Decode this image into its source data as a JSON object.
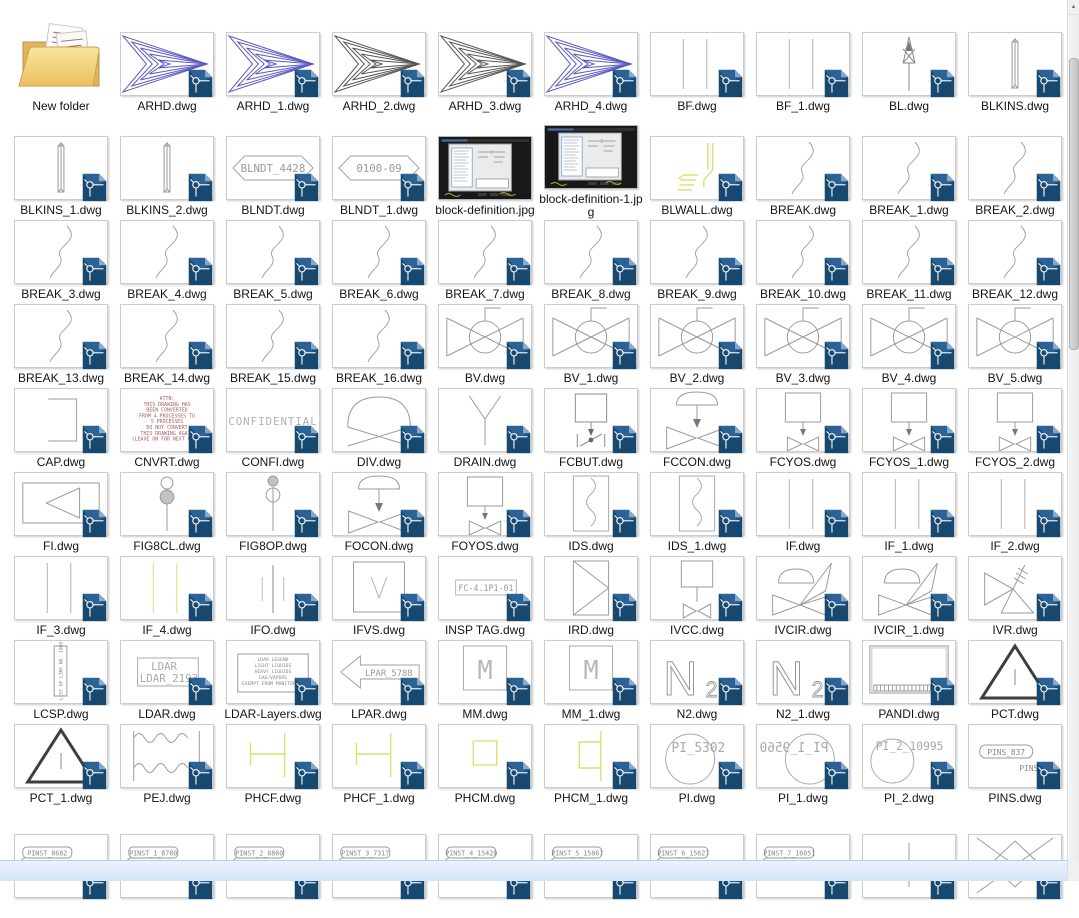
{
  "colors": {
    "dwg_badge_blue": "#17486f",
    "cad_line_gray": "#9a9a9a",
    "cad_blue": "#5b5bc0",
    "cad_dark": "#4f4f4f",
    "cad_yellow": "#dede6e",
    "cad_red": "#a75f5f",
    "folder_yellow": "#f0d47e",
    "scroll_strip_blue": "#d9e9f9"
  },
  "files": [
    {
      "label": "New folder",
      "kind": "folder"
    },
    {
      "label": "ARHD.dwg",
      "kind": "dwg",
      "glyph": "arrow",
      "variant": "blue"
    },
    {
      "label": "ARHD_1.dwg",
      "kind": "dwg",
      "glyph": "arrow",
      "variant": "blue"
    },
    {
      "label": "ARHD_2.dwg",
      "kind": "dwg",
      "glyph": "arrow",
      "variant": "dark"
    },
    {
      "label": "ARHD_3.dwg",
      "kind": "dwg",
      "glyph": "arrow",
      "variant": "dark"
    },
    {
      "label": "ARHD_4.dwg",
      "kind": "dwg",
      "glyph": "arrow",
      "variant": "blue"
    },
    {
      "label": "BF.dwg",
      "kind": "dwg",
      "glyph": "vlines2",
      "variant": "gray"
    },
    {
      "label": "BF_1.dwg",
      "kind": "dwg",
      "glyph": "vlines2",
      "variant": "gray"
    },
    {
      "label": "BL.dwg",
      "kind": "dwg",
      "glyph": "antenna"
    },
    {
      "label": "BLKINS.dwg",
      "kind": "dwg",
      "glyph": "bar3d"
    },
    {
      "label": "BLKINS_1.dwg",
      "kind": "dwg",
      "glyph": "bar3d"
    },
    {
      "label": "BLKINS_2.dwg",
      "kind": "dwg",
      "glyph": "bar3d"
    },
    {
      "label": "BLNDT.dwg",
      "kind": "dwg",
      "glyph": "hextag",
      "texts": [
        "BLNDT_4428"
      ]
    },
    {
      "label": "BLNDT_1.dwg",
      "kind": "dwg",
      "glyph": "hextag",
      "texts": [
        "0100-09"
      ]
    },
    {
      "label": "block-definition.jpg",
      "kind": "jpg",
      "variant": "1"
    },
    {
      "label": "block-definition-1.jpg",
      "kind": "jpg",
      "variant": "2"
    },
    {
      "label": "BLWALL.dwg",
      "kind": "dwg",
      "glyph": "blwall"
    },
    {
      "label": "BREAK.dwg",
      "kind": "dwg",
      "glyph": "scurve"
    },
    {
      "label": "BREAK_1.dwg",
      "kind": "dwg",
      "glyph": "scurve"
    },
    {
      "label": "BREAK_2.dwg",
      "kind": "dwg",
      "glyph": "scurve"
    },
    {
      "label": "BREAK_3.dwg",
      "kind": "dwg",
      "glyph": "scurve"
    },
    {
      "label": "BREAK_4.dwg",
      "kind": "dwg",
      "glyph": "scurve"
    },
    {
      "label": "BREAK_5.dwg",
      "kind": "dwg",
      "glyph": "scurve"
    },
    {
      "label": "BREAK_6.dwg",
      "kind": "dwg",
      "glyph": "scurve"
    },
    {
      "label": "BREAK_7.dwg",
      "kind": "dwg",
      "glyph": "scurve"
    },
    {
      "label": "BREAK_8.dwg",
      "kind": "dwg",
      "glyph": "scurve"
    },
    {
      "label": "BREAK_9.dwg",
      "kind": "dwg",
      "glyph": "scurve"
    },
    {
      "label": "BREAK_10.dwg",
      "kind": "dwg",
      "glyph": "scurve"
    },
    {
      "label": "BREAK_11.dwg",
      "kind": "dwg",
      "glyph": "scurve"
    },
    {
      "label": "BREAK_12.dwg",
      "kind": "dwg",
      "glyph": "scurve"
    },
    {
      "label": "BREAK_13.dwg",
      "kind": "dwg",
      "glyph": "scurve"
    },
    {
      "label": "BREAK_14.dwg",
      "kind": "dwg",
      "glyph": "scurve"
    },
    {
      "label": "BREAK_15.dwg",
      "kind": "dwg",
      "glyph": "scurve"
    },
    {
      "label": "BREAK_16.dwg",
      "kind": "dwg",
      "glyph": "scurve"
    },
    {
      "label": "BV.dwg",
      "kind": "dwg",
      "glyph": "ballvalve"
    },
    {
      "label": "BV_1.dwg",
      "kind": "dwg",
      "glyph": "ballvalve"
    },
    {
      "label": "BV_2.dwg",
      "kind": "dwg",
      "glyph": "ballvalve"
    },
    {
      "label": "BV_3.dwg",
      "kind": "dwg",
      "glyph": "ballvalve"
    },
    {
      "label": "BV_4.dwg",
      "kind": "dwg",
      "glyph": "ballvalve"
    },
    {
      "label": "BV_5.dwg",
      "kind": "dwg",
      "glyph": "ballvalve"
    },
    {
      "label": "CAP.dwg",
      "kind": "dwg",
      "glyph": "cap"
    },
    {
      "label": "CNVRT.dwg",
      "kind": "dwg",
      "glyph": "redtext",
      "texts": [
        "ATTN:",
        "THIS DRAWING HAS",
        "BEEN CONVERTED",
        "FROM 4 PROCESSES TO",
        "5 PROCESSES",
        "DO NOT CONVERT",
        "THIS DRAWING AGAIN",
        "(LEAVE ON FOR NEXT USER)"
      ]
    },
    {
      "label": "CONFI.dwg",
      "kind": "dwg",
      "glyph": "confidential",
      "texts": [
        "CONFIDENTIAL"
      ]
    },
    {
      "label": "DIV.dwg",
      "kind": "dwg",
      "glyph": "domex"
    },
    {
      "label": "DRAIN.dwg",
      "kind": "dwg",
      "glyph": "drainY"
    },
    {
      "label": "FCBUT.dwg",
      "kind": "dwg",
      "glyph": "fcbut"
    },
    {
      "label": "FCCON.dwg",
      "kind": "dwg",
      "glyph": "fccon"
    },
    {
      "label": "FCYOS.dwg",
      "kind": "dwg",
      "glyph": "fcyos"
    },
    {
      "label": "FCYOS_1.dwg",
      "kind": "dwg",
      "glyph": "fcyos"
    },
    {
      "label": "FCYOS_2.dwg",
      "kind": "dwg",
      "glyph": "fcyos"
    },
    {
      "label": "FI.dwg",
      "kind": "dwg",
      "glyph": "fi"
    },
    {
      "label": "FIG8CL.dwg",
      "kind": "dwg",
      "glyph": "fig8",
      "variant": "cl"
    },
    {
      "label": "FIG8OP.dwg",
      "kind": "dwg",
      "glyph": "fig8",
      "variant": "op"
    },
    {
      "label": "FOCON.dwg",
      "kind": "dwg",
      "glyph": "fccon"
    },
    {
      "label": "FOYOS.dwg",
      "kind": "dwg",
      "glyph": "fcyos"
    },
    {
      "label": "IDS.dwg",
      "kind": "dwg",
      "glyph": "ids"
    },
    {
      "label": "IDS_1.dwg",
      "kind": "dwg",
      "glyph": "ids"
    },
    {
      "label": "IF.dwg",
      "kind": "dwg",
      "glyph": "vlines2",
      "variant": "gray"
    },
    {
      "label": "IF_1.dwg",
      "kind": "dwg",
      "glyph": "vlines2",
      "variant": "gray"
    },
    {
      "label": "IF_2.dwg",
      "kind": "dwg",
      "glyph": "vlines2",
      "variant": "gray"
    },
    {
      "label": "IF_3.dwg",
      "kind": "dwg",
      "glyph": "vlines2",
      "variant": "gray"
    },
    {
      "label": "IF_4.dwg",
      "kind": "dwg",
      "glyph": "vlines2",
      "variant": "yellow"
    },
    {
      "label": "IFO.dwg",
      "kind": "dwg",
      "glyph": "ifo"
    },
    {
      "label": "IFVS.dwg",
      "kind": "dwg",
      "glyph": "ifvs"
    },
    {
      "label": "INSP TAG.dwg",
      "kind": "dwg",
      "glyph": "insptag",
      "texts": [
        "FC-4.1P1-01"
      ]
    },
    {
      "label": "IRD.dwg",
      "kind": "dwg",
      "glyph": "ird"
    },
    {
      "label": "IVCC.dwg",
      "kind": "dwg",
      "glyph": "ivcc"
    },
    {
      "label": "IVCIR.dwg",
      "kind": "dwg",
      "glyph": "ivcir"
    },
    {
      "label": "IVCIR_1.dwg",
      "kind": "dwg",
      "glyph": "ivcir"
    },
    {
      "label": "IVR.dwg",
      "kind": "dwg",
      "glyph": "ivr"
    },
    {
      "label": "LCSP.dwg",
      "kind": "dwg",
      "glyph": "lcsp",
      "texts": [
        "LIST OF LINE NO. 1989"
      ]
    },
    {
      "label": "LDAR.dwg",
      "kind": "dwg",
      "glyph": "ldar",
      "texts": [
        "LDAR",
        "LDAR_2193"
      ]
    },
    {
      "label": "LDAR-Layers.dwg",
      "kind": "dwg",
      "glyph": "ldarlayers",
      "texts": [
        "LDAR LEGEND",
        "LIGHT LIQUIDS",
        "HEAVY LIQUIDS",
        "GAS/VAPORS",
        "EXEMPT FROM MONITORING"
      ]
    },
    {
      "label": "LPAR.dwg",
      "kind": "dwg",
      "glyph": "lpararrow",
      "texts": [
        "LPAR_5788"
      ]
    },
    {
      "label": "MM.dwg",
      "kind": "dwg",
      "glyph": "msquare",
      "texts": [
        "M"
      ]
    },
    {
      "label": "MM_1.dwg",
      "kind": "dwg",
      "glyph": "msquare",
      "texts": [
        "M"
      ]
    },
    {
      "label": "N2.dwg",
      "kind": "dwg",
      "glyph": "n2text",
      "texts": [
        "N",
        "2"
      ]
    },
    {
      "label": "N2_1.dwg",
      "kind": "dwg",
      "glyph": "n2text",
      "texts": [
        "N",
        "2"
      ]
    },
    {
      "label": "PANDI.dwg",
      "kind": "dwg",
      "glyph": "pandi"
    },
    {
      "label": "PCT.dwg",
      "kind": "dwg",
      "glyph": "pcttri"
    },
    {
      "label": "PCT_1.dwg",
      "kind": "dwg",
      "glyph": "pcttri"
    },
    {
      "label": "PEJ.dwg",
      "kind": "dwg",
      "glyph": "pej"
    },
    {
      "label": "PHCF.dwg",
      "kind": "dwg",
      "glyph": "phcf"
    },
    {
      "label": "PHCF_1.dwg",
      "kind": "dwg",
      "glyph": "phcf"
    },
    {
      "label": "PHCM.dwg",
      "kind": "dwg",
      "glyph": "phcm"
    },
    {
      "label": "PHCM_1.dwg",
      "kind": "dwg",
      "glyph": "phcm1"
    },
    {
      "label": "PI.dwg",
      "kind": "dwg",
      "glyph": "picircle",
      "variant": "a",
      "texts": [
        "PI_5302"
      ]
    },
    {
      "label": "PI_1.dwg",
      "kind": "dwg",
      "glyph": "picircle",
      "variant": "m",
      "texts": [
        "PI_1_9560"
      ]
    },
    {
      "label": "PI_2.dwg",
      "kind": "dwg",
      "glyph": "picircle",
      "variant": "b",
      "texts": [
        "PI_2_10995"
      ]
    },
    {
      "label": "PINS.dwg",
      "kind": "dwg",
      "glyph": "pins",
      "texts": [
        "PINS_837",
        "PINS_828"
      ]
    },
    {
      "label": "",
      "kind": "dwg",
      "glyph": "pinst",
      "texts": [
        "PINST_8682",
        "PINST_8639"
      ]
    },
    {
      "label": "",
      "kind": "dwg",
      "glyph": "pinst",
      "texts": [
        "PINST_1_8780",
        "PINST_1_8725"
      ]
    },
    {
      "label": "",
      "kind": "dwg",
      "glyph": "pinst",
      "texts": [
        "PINST_2_8860",
        "PINST_2_9873"
      ]
    },
    {
      "label": "",
      "kind": "dwg",
      "glyph": "pinst",
      "texts": [
        "PINST_3_7317",
        "PINST_3_7330"
      ]
    },
    {
      "label": "",
      "kind": "dwg",
      "glyph": "pinst",
      "texts": [
        "PINST_4_15420",
        "PINST_4_15427"
      ]
    },
    {
      "label": "",
      "kind": "dwg",
      "glyph": "pinst",
      "texts": [
        "PINST_5_15867",
        "PINST_5_15574"
      ]
    },
    {
      "label": "",
      "kind": "dwg",
      "glyph": "pinst",
      "texts": [
        "PINST_6_15627",
        "PINST_6_15640"
      ]
    },
    {
      "label": "",
      "kind": "dwg",
      "glyph": "pinst",
      "texts": [
        "PINST_7_16051",
        "PINST_7_16058"
      ]
    },
    {
      "label": "",
      "kind": "dwg",
      "glyph": "cross"
    },
    {
      "label": "",
      "kind": "dwg",
      "glyph": "xdiamond"
    }
  ]
}
